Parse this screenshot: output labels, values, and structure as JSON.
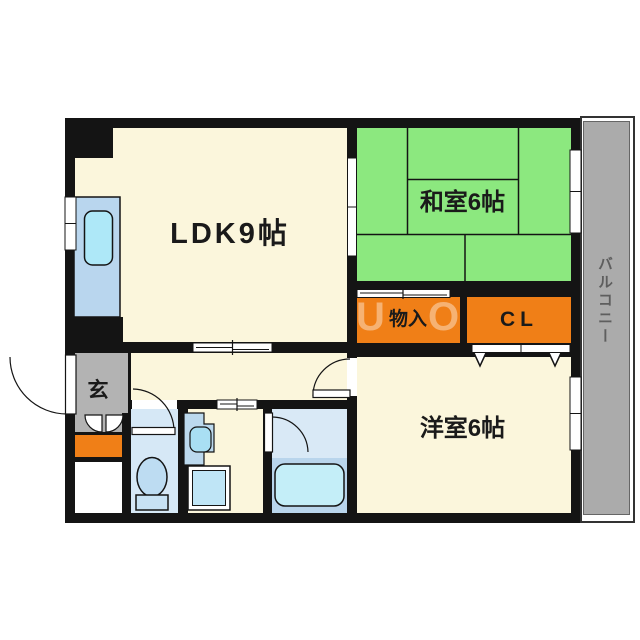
{
  "plan": {
    "rooms": {
      "ldk": "LDK9帖",
      "japanese_room": "和室6帖",
      "western_room": "洋室6帖",
      "storage": "物入",
      "closet": "CL",
      "entrance": "玄",
      "balcony": "バルコニー"
    },
    "watermark": {
      "left": "U",
      "right": "O"
    },
    "colors": {
      "wall": "#141414",
      "floor_cream": "#FBF6DC",
      "tatami_green": "#8CE87F",
      "storage_orange": "#F07F17",
      "balcony_gray": "#ABABAB",
      "entrance_gray": "#B3B3B3",
      "toilet_blue": "#D6E8F6",
      "bath_blue": "#D9E9F6",
      "fixture_blue": "#BDDCF2",
      "kitchen_blue": "#B9D6EE",
      "sink_cyan": "#AEE8F8",
      "label_dark": "#1A1A1A",
      "balcony_text": "#5E5E5E"
    }
  }
}
